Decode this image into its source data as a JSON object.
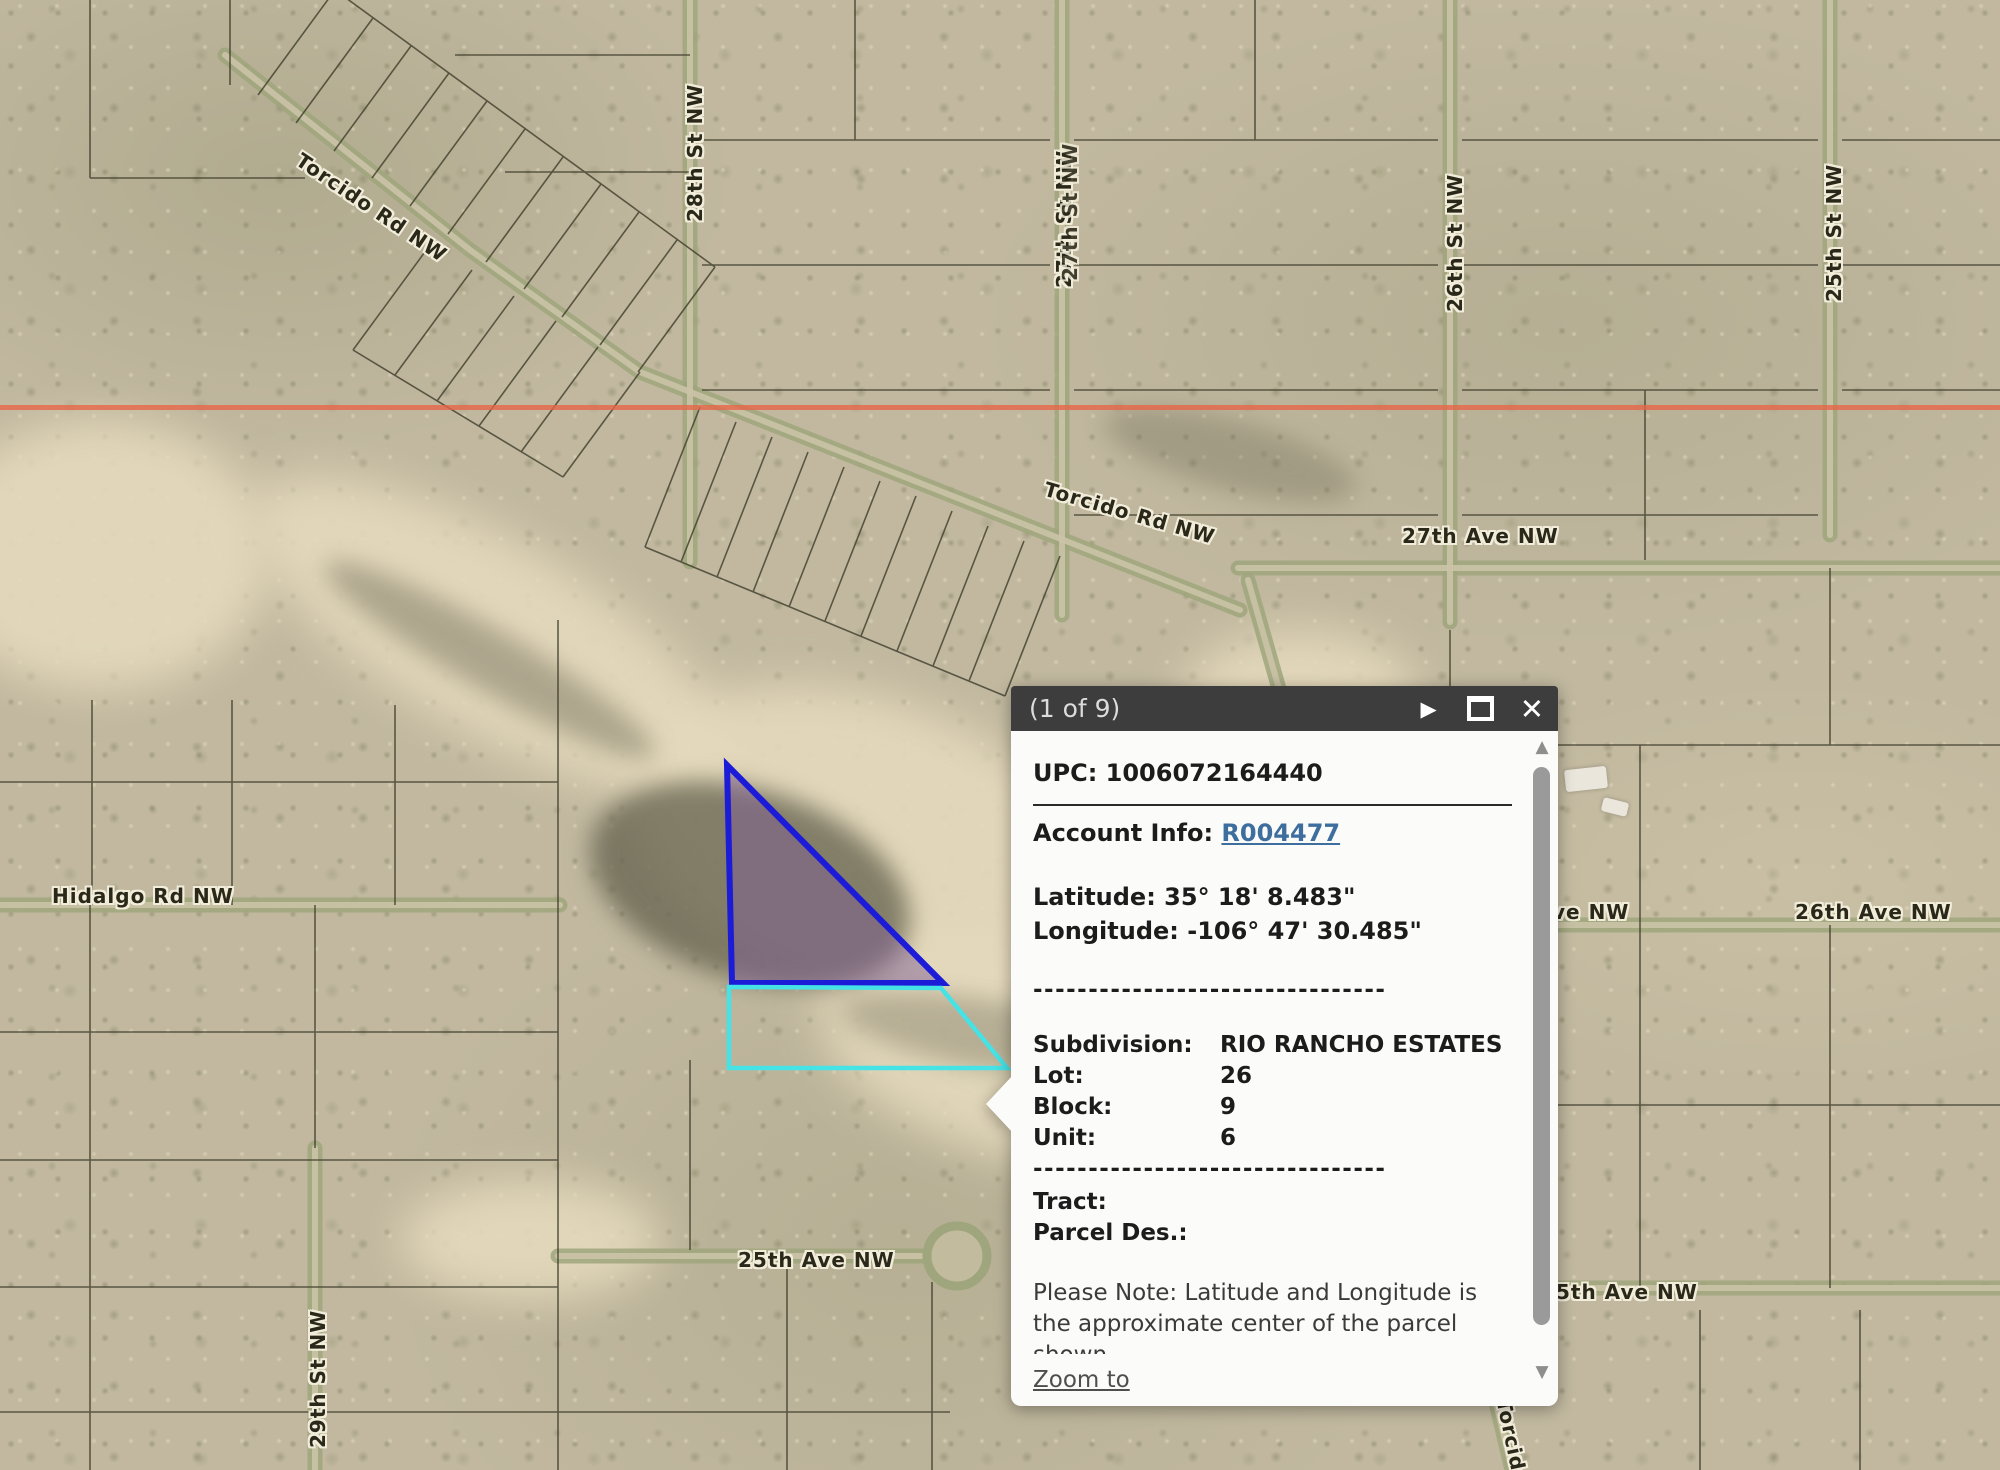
{
  "map": {
    "road_labels": {
      "torcido_upper": "Torcido Rd NW",
      "torcido_lower": "Torcido Rd NW",
      "st_28": "28th St NW",
      "st_27": "27th St NW",
      "st_26": "26th St NW",
      "st_25": "25th St NW",
      "st_29": "29th St NW",
      "ave_27": "27th Ave NW",
      "hidalgo": "Hidalgo Rd NW",
      "ave_26_partial": "ve NW",
      "ave_26": "26th Ave NW",
      "ave_25": "25th Ave NW",
      "ave_25_right": "5th Ave NW",
      "torcido_bottom": "Torcido"
    },
    "colors": {
      "selected_parcel_outline": "#1b1bd8",
      "selected_parcel_fill": "rgba(125,92,150,0.48)",
      "adjacent_parcel_outline": "#45e2e6",
      "section_line": "rgba(232,100,70,0.78)"
    }
  },
  "popup": {
    "title": "(1 of 9)",
    "icons": {
      "next_glyph": "▶",
      "close_glyph": "✕",
      "scroll_up_glyph": "▲",
      "scroll_down_glyph": "▼"
    },
    "upc_label": "UPC:",
    "upc_value": "1006072164440",
    "account_label": "Account Info:",
    "account_link": "R004477",
    "latitude_label": "Latitude:",
    "latitude_value": "35° 18' 8.483\"",
    "longitude_label": "Longitude:",
    "longitude_value": "-106° 47' 30.485\"",
    "divider_dashes": "--------------------------------",
    "subdivision_label": "Subdivision:",
    "subdivision_value": "RIO RANCHO ESTATES",
    "lot_label": "Lot:",
    "lot_value": "26",
    "block_label": "Block:",
    "block_value": "9",
    "unit_label": "Unit:",
    "unit_value": "6",
    "tract_label": "Tract:",
    "parcel_des_label": "Parcel Des.:",
    "note": "Please Note: Latitude and Longitude is the approximate center of the parcel shown.",
    "zoom_to_label": "Zoom to"
  }
}
